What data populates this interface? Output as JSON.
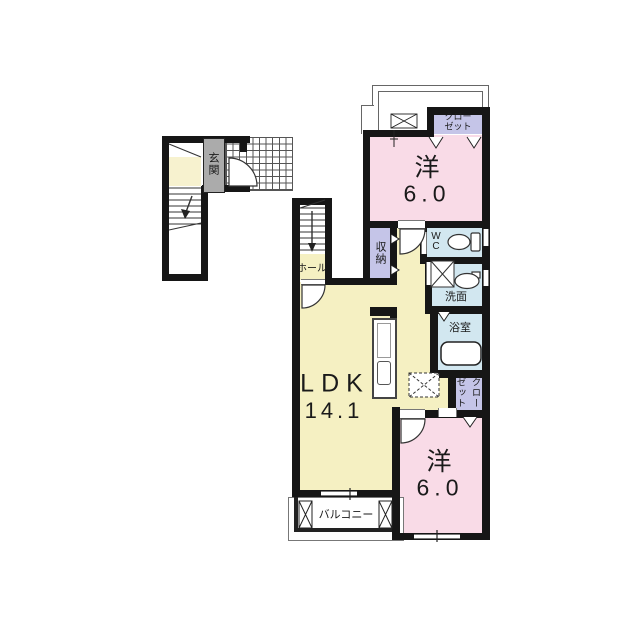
{
  "plan": {
    "bedroom_top": {
      "name": "洋",
      "size": "6.0"
    },
    "bedroom_bottom": {
      "name": "洋",
      "size": "6.0"
    },
    "ldk": {
      "name": "LDK",
      "size": "14.1"
    },
    "hall": {
      "label": "ホール"
    },
    "entrance": {
      "label": "玄関"
    },
    "storage": {
      "label": "収納"
    },
    "wc": {
      "l1": "W",
      "l2": "C"
    },
    "washroom": {
      "label": "洗面"
    },
    "bathroom": {
      "label": "浴室"
    },
    "closet_top": {
      "l1": "クロー",
      "l2": "ゼット"
    },
    "closet_bottom": {
      "l1": "クロー",
      "l2": "ゼット"
    },
    "balcony": {
      "label": "バルコニー"
    }
  },
  "colors": {
    "bedroom_pink": "#f9dbe7",
    "ldk_yellow": "#f5f0c2",
    "wet_area_blue": "#d2e7f0",
    "closet_lavender": "#c5c5e8",
    "entrance_gray": "#ababab",
    "wall_black": "#161616"
  }
}
